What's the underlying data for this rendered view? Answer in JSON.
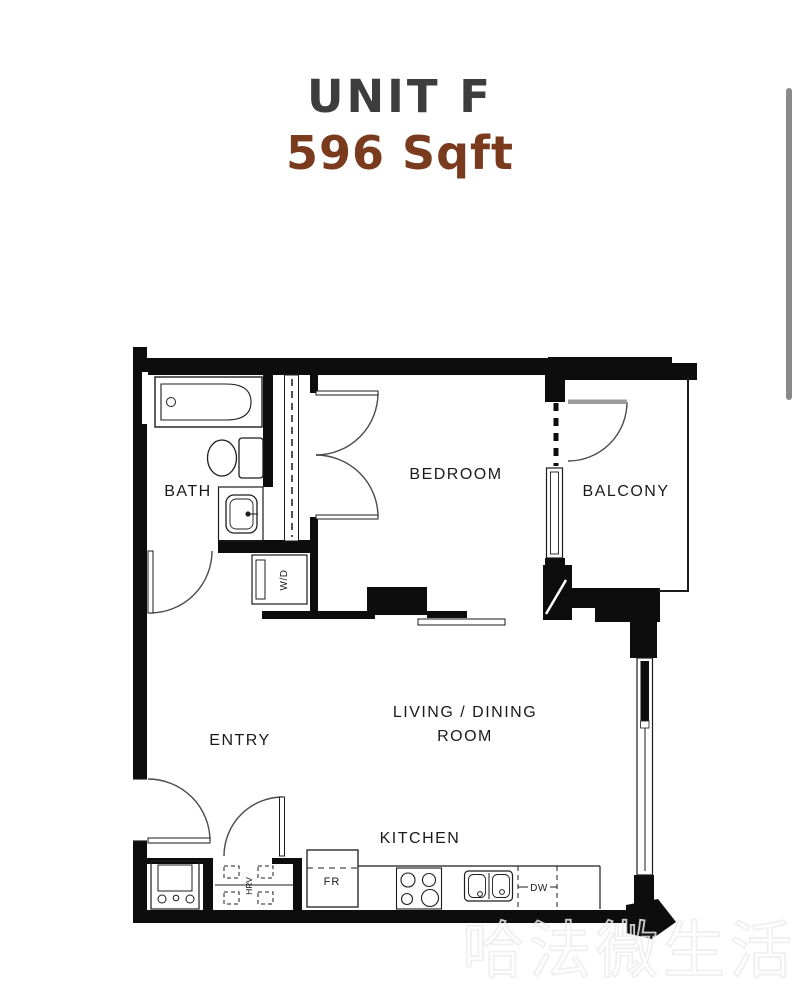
{
  "title": {
    "unit": "UNIT F",
    "area": "596 Sqft"
  },
  "colors": {
    "unit_title": "#3d3d3d",
    "area_accent": "#7a3a1e",
    "plan_ink": "#0d0d0d",
    "scrollbar": "#8a8a8a"
  },
  "floorplan": {
    "rooms": {
      "bath": "BATH",
      "bedroom": "BEDROOM",
      "balcony": "BALCONY",
      "entry": "ENTRY",
      "living_line1": "LIVING / DINING",
      "living_line2": "ROOM",
      "kitchen": "KITCHEN"
    },
    "fixtures": {
      "washer_dryer": "W/D",
      "fridge": "FR",
      "ventilation": "HRV",
      "dishwasher": "DW"
    }
  },
  "watermark": {
    "text": "哈法微生活"
  }
}
